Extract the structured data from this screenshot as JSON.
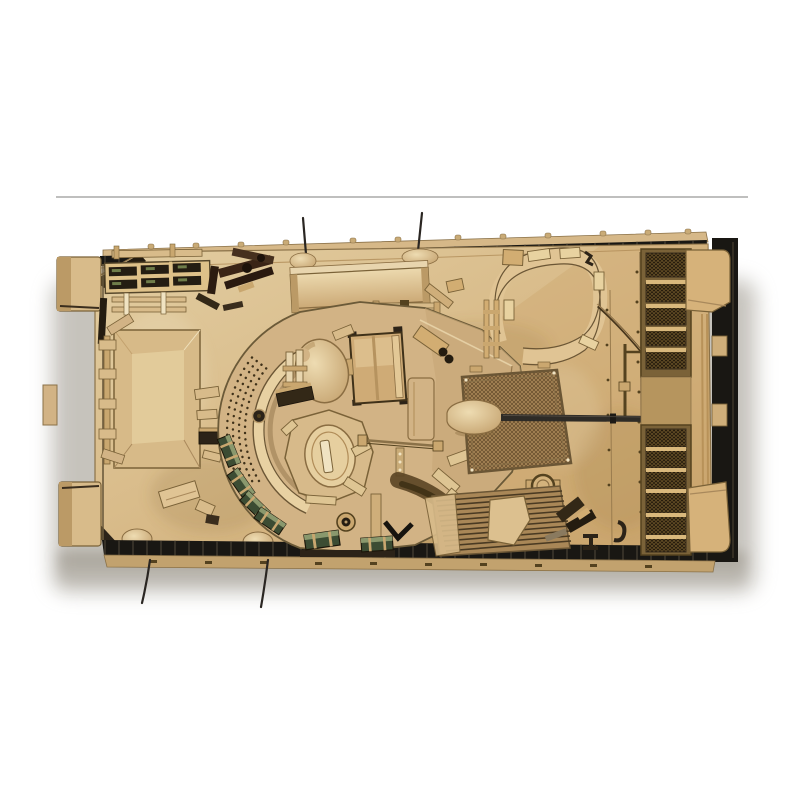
{
  "meta": {
    "image_type": "product-photo",
    "subject": "Top-down view of a desert-sand coloured armored infantry fighting vehicle scale model (Bradley-style IFV) with turret, twin crew hatches and gun barrel pointing right",
    "setting": "white studio background with a faint horizontal shelf line above the model and a soft grey drop shadow beneath it"
  },
  "palette": {
    "bg": "#ffffff",
    "shelf_line": "#9c9c9a",
    "shadow": "#8e887c",
    "hull_light": "#e7d2a6",
    "hull_base": "#d9bc8c",
    "hull_gold": "#cfa972",
    "hull_dark": "#b6955e",
    "edge_brown": "#7a6238",
    "deep_brown": "#54421f",
    "near_black": "#241c10",
    "track_black": "#191713",
    "cream": "#f0e3c2",
    "green_dark": "#3c4c33",
    "green_light": "#8a986d",
    "barrel": "#2e2b26",
    "metal_gray": "#6a6156",
    "swoosh_brown": "#5a4424"
  },
  "scene": {
    "shelf_line": {
      "x1": 56,
      "y1": 197,
      "x2": 748,
      "y2": 197
    }
  },
  "model": {
    "label": "Desert-tan armored fighting vehicle scale model, top view",
    "parts": [
      {
        "id": "hull-deck",
        "label": "Hull top deck"
      },
      {
        "id": "track-top",
        "label": "Upper track run"
      },
      {
        "id": "track-bottom",
        "label": "Lower track run"
      },
      {
        "id": "squad-hatch",
        "label": "Left squad hatch panel"
      },
      {
        "id": "tool-rack",
        "label": "Pioneer tool rack with periscope slots"
      },
      {
        "id": "mg-stowage",
        "label": "Stowed machine-gun / tripod cluster"
      },
      {
        "id": "stowage-box",
        "label": "Long stowage bin"
      },
      {
        "id": "turret",
        "label": "Turret with ring and perforated band"
      },
      {
        "id": "commander-hatch",
        "label": "Commander's hatch dome"
      },
      {
        "id": "gunner-hatch",
        "label": "Gunner's hatch"
      },
      {
        "id": "sight-box",
        "label": "Gunner's sight housing"
      },
      {
        "id": "ammo-boxes",
        "label": "Green ammunition boxes"
      },
      {
        "id": "gun-mantlet",
        "label": "Gun mantlet cover"
      },
      {
        "id": "gun-barrel",
        "label": "25mm gun barrel"
      },
      {
        "id": "engine-hatch",
        "label": "Curved engine access hatch"
      },
      {
        "id": "radiator",
        "label": "Radiator mesh panel"
      },
      {
        "id": "louvers-top",
        "label": "Engine intake louvers, upper bank"
      },
      {
        "id": "louvers-bottom",
        "label": "Engine intake louvers, lower bank"
      },
      {
        "id": "side-skirts",
        "label": "Right-side skirt armour blocks"
      },
      {
        "id": "tow-cable",
        "label": "Tow cable and fuel lines"
      },
      {
        "id": "antennas",
        "label": "Whip antennas"
      },
      {
        "id": "vent-ribs",
        "label": "Ribbed exhaust vents"
      },
      {
        "id": "drop-shadow",
        "label": "Soft drop shadow"
      },
      {
        "id": "shelf-line",
        "label": "Background shelf line"
      }
    ]
  }
}
